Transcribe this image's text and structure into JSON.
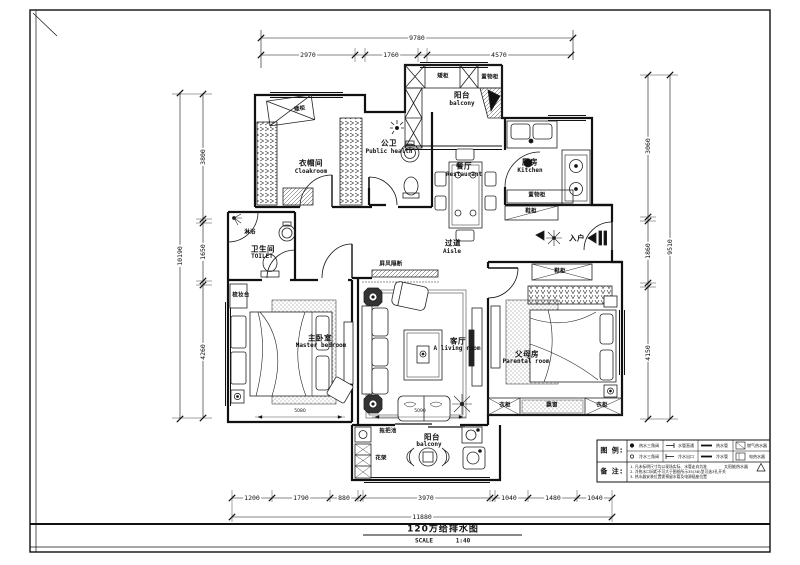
{
  "frame": {
    "title": "120方给排水图",
    "scale_label": "SCALE",
    "scale_value": "1:40"
  },
  "rooms": {
    "cloakroom": {
      "cn": "衣帽间",
      "en": "Cloakroom"
    },
    "public_bath": {
      "cn": "公卫",
      "en": "Public health"
    },
    "balcony_top": {
      "cn": "阳台",
      "en": "balcony"
    },
    "dining": {
      "cn": "餐厅",
      "en": "Restaurant"
    },
    "kitchen": {
      "cn": "厨房",
      "en": "Kitchen"
    },
    "aisle": {
      "cn": "过道",
      "en": "Aisle"
    },
    "toilet": {
      "cn": "卫生间",
      "en": "TOILET"
    },
    "master_bedroom": {
      "cn": "主卧室",
      "en": "Master bedroom"
    },
    "living_room": {
      "cn": "客厅",
      "en": "A living room"
    },
    "parents_room": {
      "cn": "父母房",
      "en": "Parental room"
    },
    "balcony_bottom": {
      "cn": "阳台",
      "en": "balcony"
    },
    "entry": {
      "cn": "入户"
    }
  },
  "fixtures": {
    "low_cabinet_cloakroom": "矮柜",
    "low_cabinet_balcony": "矮柜",
    "storage_cabinet_balcony": "置物柜",
    "storage_cabinet_kitchen": "置物柜",
    "shoe_cabinet_kitchen": "鞋柜",
    "shoe_cabinet_entry": "鞋柜",
    "shower": "淋浴",
    "dressing_table": "梳妆台",
    "screen_partition": "屏风隔断",
    "wardrobe_left": "衣柜",
    "bay_window": "飘窗",
    "wardrobe_right": "衣柜",
    "mop_pool": "拖把池",
    "flower_rack": "花架"
  },
  "dimensions": {
    "top": {
      "total": "9780",
      "segments": [
        "2970",
        "1760",
        "4570"
      ]
    },
    "bottom": {
      "total": "11880",
      "segments": [
        "1200",
        "1790",
        "880",
        "3970",
        "1040",
        "1480",
        "1040"
      ]
    },
    "left": {
      "total": "10190",
      "segments": [
        "3800",
        "1650",
        "4260"
      ]
    },
    "right": {
      "total": "9510",
      "segments": [
        "3060",
        "1860",
        "4150"
      ]
    },
    "interior": {
      "master_width": "5080",
      "living_width": "5090"
    }
  },
  "legend": {
    "header": "图 例:",
    "rows": [
      {
        "items": [
          "热水三角阀",
          "水管直通",
          "热水管",
          "燃气热水器"
        ]
      },
      {
        "items": [
          "冷水三角阀",
          "冷水出口",
          "冷水管",
          "电热水器"
        ]
      }
    ],
    "solar": "太阳能热水器",
    "notes_header": "备 注:",
    "notes": [
      "1. 凡未标明尺寸均以现场实际、水管走向为准",
      "2. 冷热水口间距不可大于图纸所示35(38)型可选3孔开关",
      "3. 热水器安装位置需预留水管及电源插座位置"
    ]
  }
}
